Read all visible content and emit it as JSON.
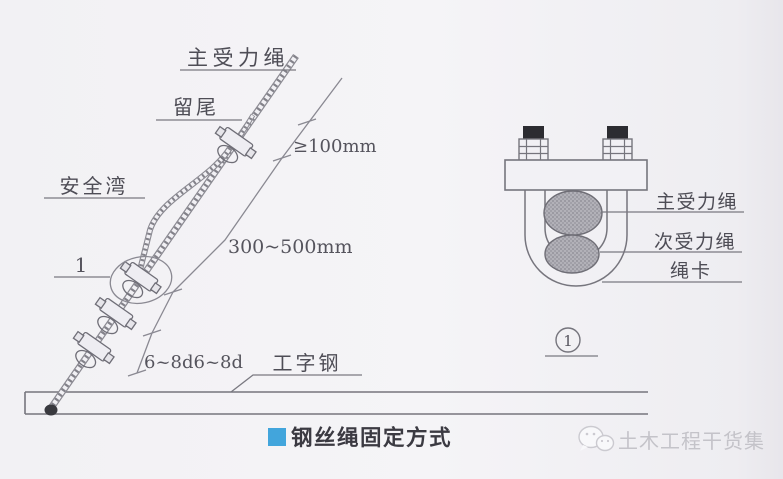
{
  "colors": {
    "paper": "#f4f3f6",
    "line_gray": "#7a7981",
    "ink": "#4e4d56",
    "accent_blue": "#42a5dc",
    "caption_ink": "#3b3a42",
    "watermark_gray": "#c4c3c9",
    "rope_fill_gray": "#b2b1b8",
    "bolt_cap_black": "#2c2c31"
  },
  "left_figure": {
    "labels": {
      "main_rope": "主受力绳",
      "tail": "留尾",
      "safety_loop": "安全湾",
      "detail_ref": "1",
      "i_beam": "工字钢"
    },
    "dimensions": {
      "tail_min_length": "≥100mm",
      "loop_length": "300~500mm",
      "clamp_spacing": "6~8d6~8d"
    }
  },
  "right_figure": {
    "labels": {
      "main_rope": "主受力绳",
      "secondary_rope": "次受力绳",
      "rope_clamp": "绳卡",
      "detail_mark": "1"
    }
  },
  "caption": {
    "title": "钢丝绳固定方式"
  },
  "watermark": {
    "text": "土木工程干货集"
  }
}
